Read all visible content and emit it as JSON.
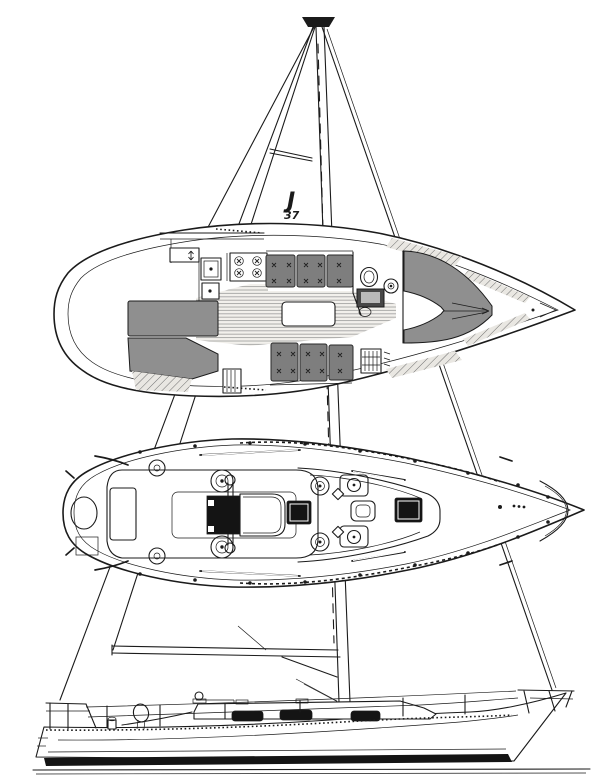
{
  "sail_logo": {
    "letter": "J",
    "number": "37"
  },
  "colors": {
    "ink": "#1b1b1b",
    "paper": "#ffffff",
    "cushion": "#7e7e7e",
    "cushion_edge": "#2a2a2a",
    "berth": "#8f8f8f",
    "hatch_black": "#141414",
    "teak_line": "#9b9b9b",
    "hatch_line": "#6f6f6f"
  }
}
